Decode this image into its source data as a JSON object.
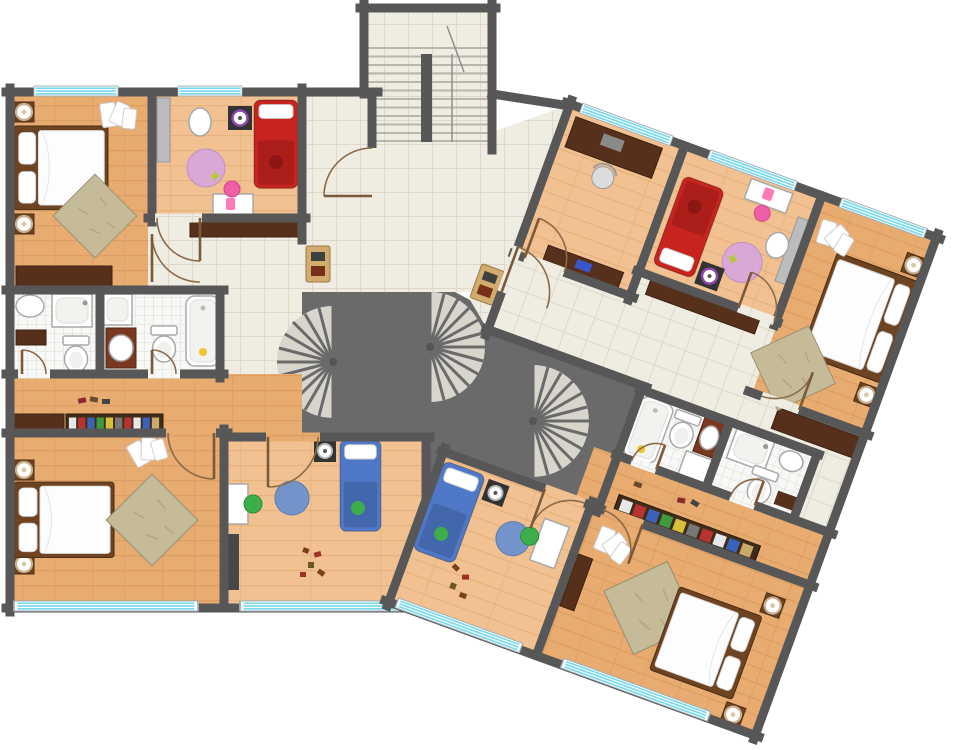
{
  "canvas": {
    "width": 954,
    "height": 750,
    "background": "#ffffff"
  },
  "palette": {
    "wall": "#575757",
    "core": "#6a6a6a",
    "wood": "#e8ab70",
    "woodLight": "#f1c191",
    "tile": "#efece2",
    "bathTile": "#f8f8f6",
    "window": "#7bd9ec",
    "windowFrame": "#9fb0b5",
    "fanTread": "#d8d5cc",
    "bedFrame": "#6e4322",
    "bedWhite": "#fdfdfd",
    "bedRed": "#c7231f",
    "bedBlue": "#4f79c8",
    "rugBeige": "#c6bb98",
    "rugPink": "#d9a8d6",
    "rugBlue": "#7394cb",
    "chairGreen": "#3dae4b",
    "chairPink": "#ee5fa7",
    "furnitureDark": "#56301a",
    "vanity": "#7a3820",
    "consoleTan": "#d2ab6e",
    "grayWardrobe": "#bcbcbc",
    "accentPurple": "#8e44ad",
    "duck": "#e8c636"
  },
  "building": {
    "type": "residential-floor-plan",
    "common_areas": {
      "stairwell": {
        "name": "main-stairwell",
        "floor": "tile",
        "treads": 12,
        "flights": 2
      },
      "landing": {
        "name": "stair-landing",
        "floor": "tile",
        "furniture": [
          "console-table",
          "console-table"
        ]
      },
      "core": {
        "name": "central-core",
        "spiral_staircases": 3
      }
    },
    "window_count": 9,
    "units": [
      {
        "id": "unit-left",
        "rotation_deg": 0,
        "rooms": [
          {
            "name": "master-bedroom",
            "floor": "wood",
            "furniture": [
              "double-bed",
              "nightstand-with-lamp",
              "nightstand-with-lamp",
              "area-rug",
              "dresser",
              "clothes-pile"
            ]
          },
          {
            "name": "kids-bedroom-red",
            "floor": "wood",
            "furniture": [
              "single-bed-red",
              "round-rug-pink",
              "desk",
              "chair-pink",
              "laundry-basket",
              "toy-speaker",
              "gray-wardrobe"
            ]
          },
          {
            "name": "hallway",
            "floor": "tile",
            "furniture": [
              "sideboard",
              "console-table"
            ]
          },
          {
            "name": "bathroom-shower",
            "floor": "ceramic",
            "fixtures": [
              "corner-sink",
              "shower",
              "toilet",
              "cabinet"
            ]
          },
          {
            "name": "bathroom-bathtub",
            "floor": "ceramic",
            "fixtures": [
              "shower",
              "vanity-sink",
              "toilet",
              "bathtub",
              "rubber-duck"
            ]
          },
          {
            "name": "lower-hall",
            "floor": "wood",
            "furniture": [
              "wardrobe",
              "shoe-rack",
              "shoes"
            ]
          },
          {
            "name": "bedroom-second",
            "floor": "wood",
            "furniture": [
              "double-bed",
              "nightstand-with-lamp",
              "nightstand-with-lamp",
              "area-rug",
              "clothes-pile"
            ]
          },
          {
            "name": "kids-bedroom-blue",
            "floor": "wood",
            "furniture": [
              "single-bed-blue",
              "round-rug-blue",
              "desk",
              "chair-green",
              "toy-speaker",
              "wardrobe",
              "toys"
            ]
          }
        ]
      },
      {
        "id": "unit-right",
        "rotation_deg": 20,
        "rooms": [
          {
            "name": "study-office",
            "floor": "wood",
            "furniture": [
              "desk-dark",
              "office-chair",
              "sideboard"
            ]
          },
          {
            "name": "kids-bedroom-red",
            "floor": "wood",
            "furniture": [
              "single-bed-red",
              "round-rug-pink",
              "desk",
              "chair-pink",
              "laundry-basket",
              "toy-speaker",
              "gray-wardrobe"
            ]
          },
          {
            "name": "master-bedroom",
            "floor": "wood",
            "furniture": [
              "double-bed",
              "nightstand-with-lamp",
              "nightstand-with-lamp",
              "area-rug",
              "clothes-pile",
              "dresser"
            ]
          },
          {
            "name": "hallway",
            "floor": "tile",
            "furniture": [
              "sideboard",
              "wardrobe"
            ]
          },
          {
            "name": "bathroom-bathtub",
            "floor": "ceramic",
            "fixtures": [
              "bathtub",
              "toilet",
              "vanity-sink",
              "shower",
              "rubber-duck"
            ]
          },
          {
            "name": "bathroom-shower",
            "floor": "ceramic",
            "fixtures": [
              "corner-shower",
              "sink",
              "toilet",
              "cabinet"
            ]
          },
          {
            "name": "lower-hall",
            "floor": "wood",
            "furniture": [
              "shoe-rack",
              "shoes"
            ]
          },
          {
            "name": "kids-bedroom-blue",
            "floor": "wood",
            "furniture": [
              "single-bed-blue",
              "round-rug-blue",
              "desk",
              "chair-green",
              "toy-speaker",
              "toys"
            ]
          },
          {
            "name": "master-bedroom-second",
            "floor": "wood",
            "furniture": [
              "double-bed",
              "nightstand-with-lamp",
              "nightstand-with-lamp",
              "area-rug",
              "clothes-pile",
              "dresser"
            ]
          }
        ]
      }
    ]
  }
}
